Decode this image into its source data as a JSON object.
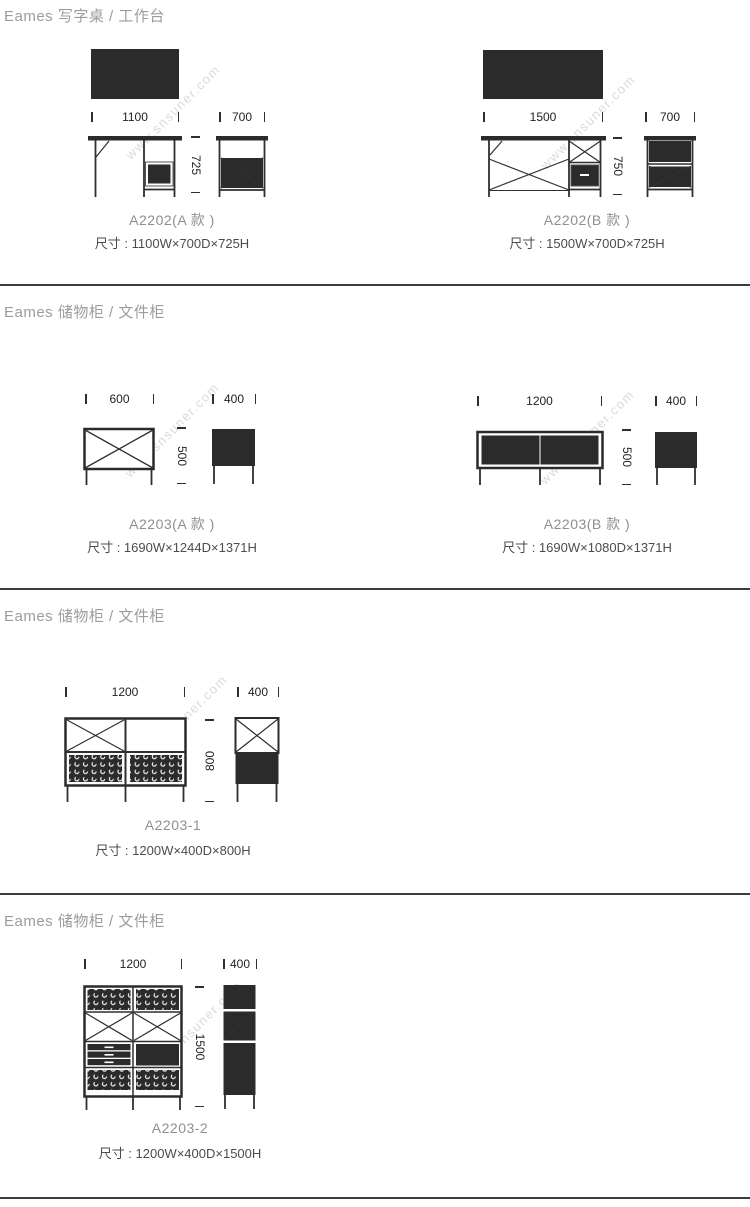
{
  "watermark": {
    "text": "www.snsuner.com"
  },
  "sections": [
    {
      "title": "Eames 写字桌 / 工作台",
      "products": [
        {
          "code": "A2202(A 款 )",
          "size_label": "尺寸 : 1100W×700D×725H",
          "width_mm": "1100",
          "depth_mm": "700",
          "height_mm": "725"
        },
        {
          "code": "A2202(B 款 )",
          "size_label": "尺寸 : 1500W×700D×725H",
          "width_mm": "1500",
          "depth_mm": "700",
          "height_mm": "750"
        }
      ]
    },
    {
      "title": "Eames 储物柜 / 文件柜",
      "products": [
        {
          "code": "A2203(A 款 )",
          "size_label": "尺寸 : 1690W×1244D×1371H",
          "width_mm": "600",
          "depth_mm": "400",
          "height_mm": "500"
        },
        {
          "code": "A2203(B 款 )",
          "size_label": "尺寸 : 1690W×1080D×1371H",
          "width_mm": "1200",
          "depth_mm": "400",
          "height_mm": "500"
        }
      ]
    },
    {
      "title": "Eames 储物柜 / 文件柜",
      "products": [
        {
          "code": "A2203-1",
          "size_label": "尺寸 : 1200W×400D×800H",
          "width_mm": "1200",
          "depth_mm": "400",
          "height_mm": "800"
        }
      ]
    },
    {
      "title": "Eames 储物柜 / 文件柜",
      "products": [
        {
          "code": "A2203-2",
          "size_label": "尺寸 : 1200W×400D×1500H",
          "width_mm": "1200",
          "depth_mm": "400",
          "height_mm": "1500"
        }
      ]
    }
  ]
}
